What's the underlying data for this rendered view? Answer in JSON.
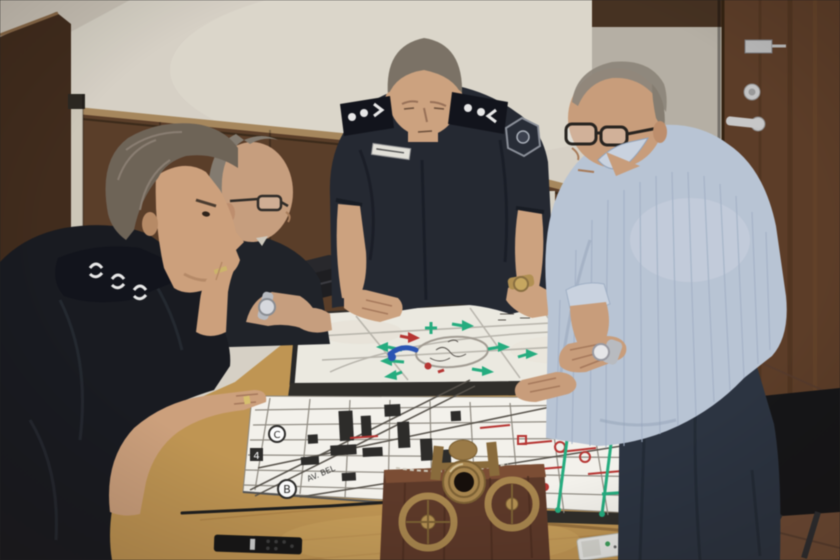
{
  "meta": {
    "type": "photograph",
    "description": "Three police officers in dark uniforms and a man in a light blue striped shirt study a large annotated city street map laid on a wooden meeting table; behind them are a cream wall with dark wood wainscoting and a dark wooden door. A small brass cannon model, a black remote control, a white remote, a pointer stick and a telephone sit on the table."
  },
  "scene": {
    "people": [
      {
        "id": "officer-foreground",
        "label": "seated officer, profile view, hand on chin, gold ring, epaulette with white insignia"
      },
      {
        "id": "officer-middle",
        "label": "seated balding officer with glasses, arms crossed, silver wristwatch"
      },
      {
        "id": "officer-standing",
        "label": "standing officer leaning over map, epaulettes, shoulder patch, white name tag, gold watch"
      },
      {
        "id": "civilian-man",
        "label": "balding man in light blue striped shirt, dark glasses, white-faced wristwatch, hands on map"
      }
    ],
    "objects": [
      {
        "id": "map-board-upper",
        "label": "framed map with green, red and blue marker annotations around a ring road"
      },
      {
        "id": "map-board-lower",
        "label": "framed city street-grid map with red street names, green route lines and circled markers"
      },
      {
        "id": "cannon-model",
        "label": "small brass cannon model on wooden base facing camera"
      },
      {
        "id": "tv-remote",
        "label": "black remote control on table"
      },
      {
        "id": "ac-remote",
        "label": "small white remote on table"
      },
      {
        "id": "pointer-stick",
        "label": "thin black pointer rod on table"
      },
      {
        "id": "desk-phone",
        "label": "black telephone on table"
      },
      {
        "id": "wooden-door",
        "label": "dark brown wooden door with metal hinge, lock cylinder and lever handle"
      },
      {
        "id": "office-chairs",
        "label": "black office chairs"
      }
    ],
    "map": {
      "markers": {
        "circled_b": "B",
        "circled_c": "C",
        "boxed_4": "4",
        "avenue_label": "AV. BEL"
      }
    }
  },
  "palette": {
    "wall": "#d8d2c6",
    "wainscot": "#5a3c26",
    "wainscot_rail": "#a8875a",
    "left_panel": "#402a1a",
    "strip": "#cfc8b8",
    "gray_panel": "#b6b0a4",
    "gray_panel_bar": "#46301f",
    "door": "#5c3b25",
    "hardware": "#c4c4c4",
    "floor": "#6f4a32",
    "chair": "#141416",
    "radiator": "#d9d4c6",
    "table": "#c2954f",
    "table_edge": "#dcb375",
    "map_paper_upper": "#edebe2",
    "map_paper_lower": "#f5f3ed",
    "frame_dark": "#2e2c28",
    "street": "#8f8a80",
    "map_green": "#1fae7e",
    "map_red": "#bb3330",
    "map_blue": "#2853b8",
    "uniform_foreground": "#17191f",
    "uniform_middle": "#1e2127",
    "uniform_standing": "#232731",
    "epaulette": "#10121a",
    "insignia": "#e9e9e9",
    "skin_foreground": "#cfa07a",
    "skin_middle": "#c99e7c",
    "skin_standing": "#cfa27d",
    "skin_civilian": "#cb9d79",
    "hair_foreground": "#6e6356",
    "hair_middle": "#837b6f",
    "hair_standing": "#7b7265",
    "hair_civilian": "#8e867a",
    "shirt": "#b9c5d6",
    "shirt_stripe": "#a3b2c8",
    "collar": "#cad4e2",
    "pants": "#2a3240",
    "watch_silver": "#b9bcc2",
    "watch_gold": "#b3904e",
    "brass": "#a9854a",
    "brass_dark": "#7c5f30",
    "muzzle": "#140d08",
    "base_wood": "#5d3726",
    "base_wood_top": "#7c4c31",
    "remote_black": "#151515",
    "remote_white": "#e9e9e5",
    "rod": "#1d1d1d",
    "nametag": "#e4e2da"
  }
}
